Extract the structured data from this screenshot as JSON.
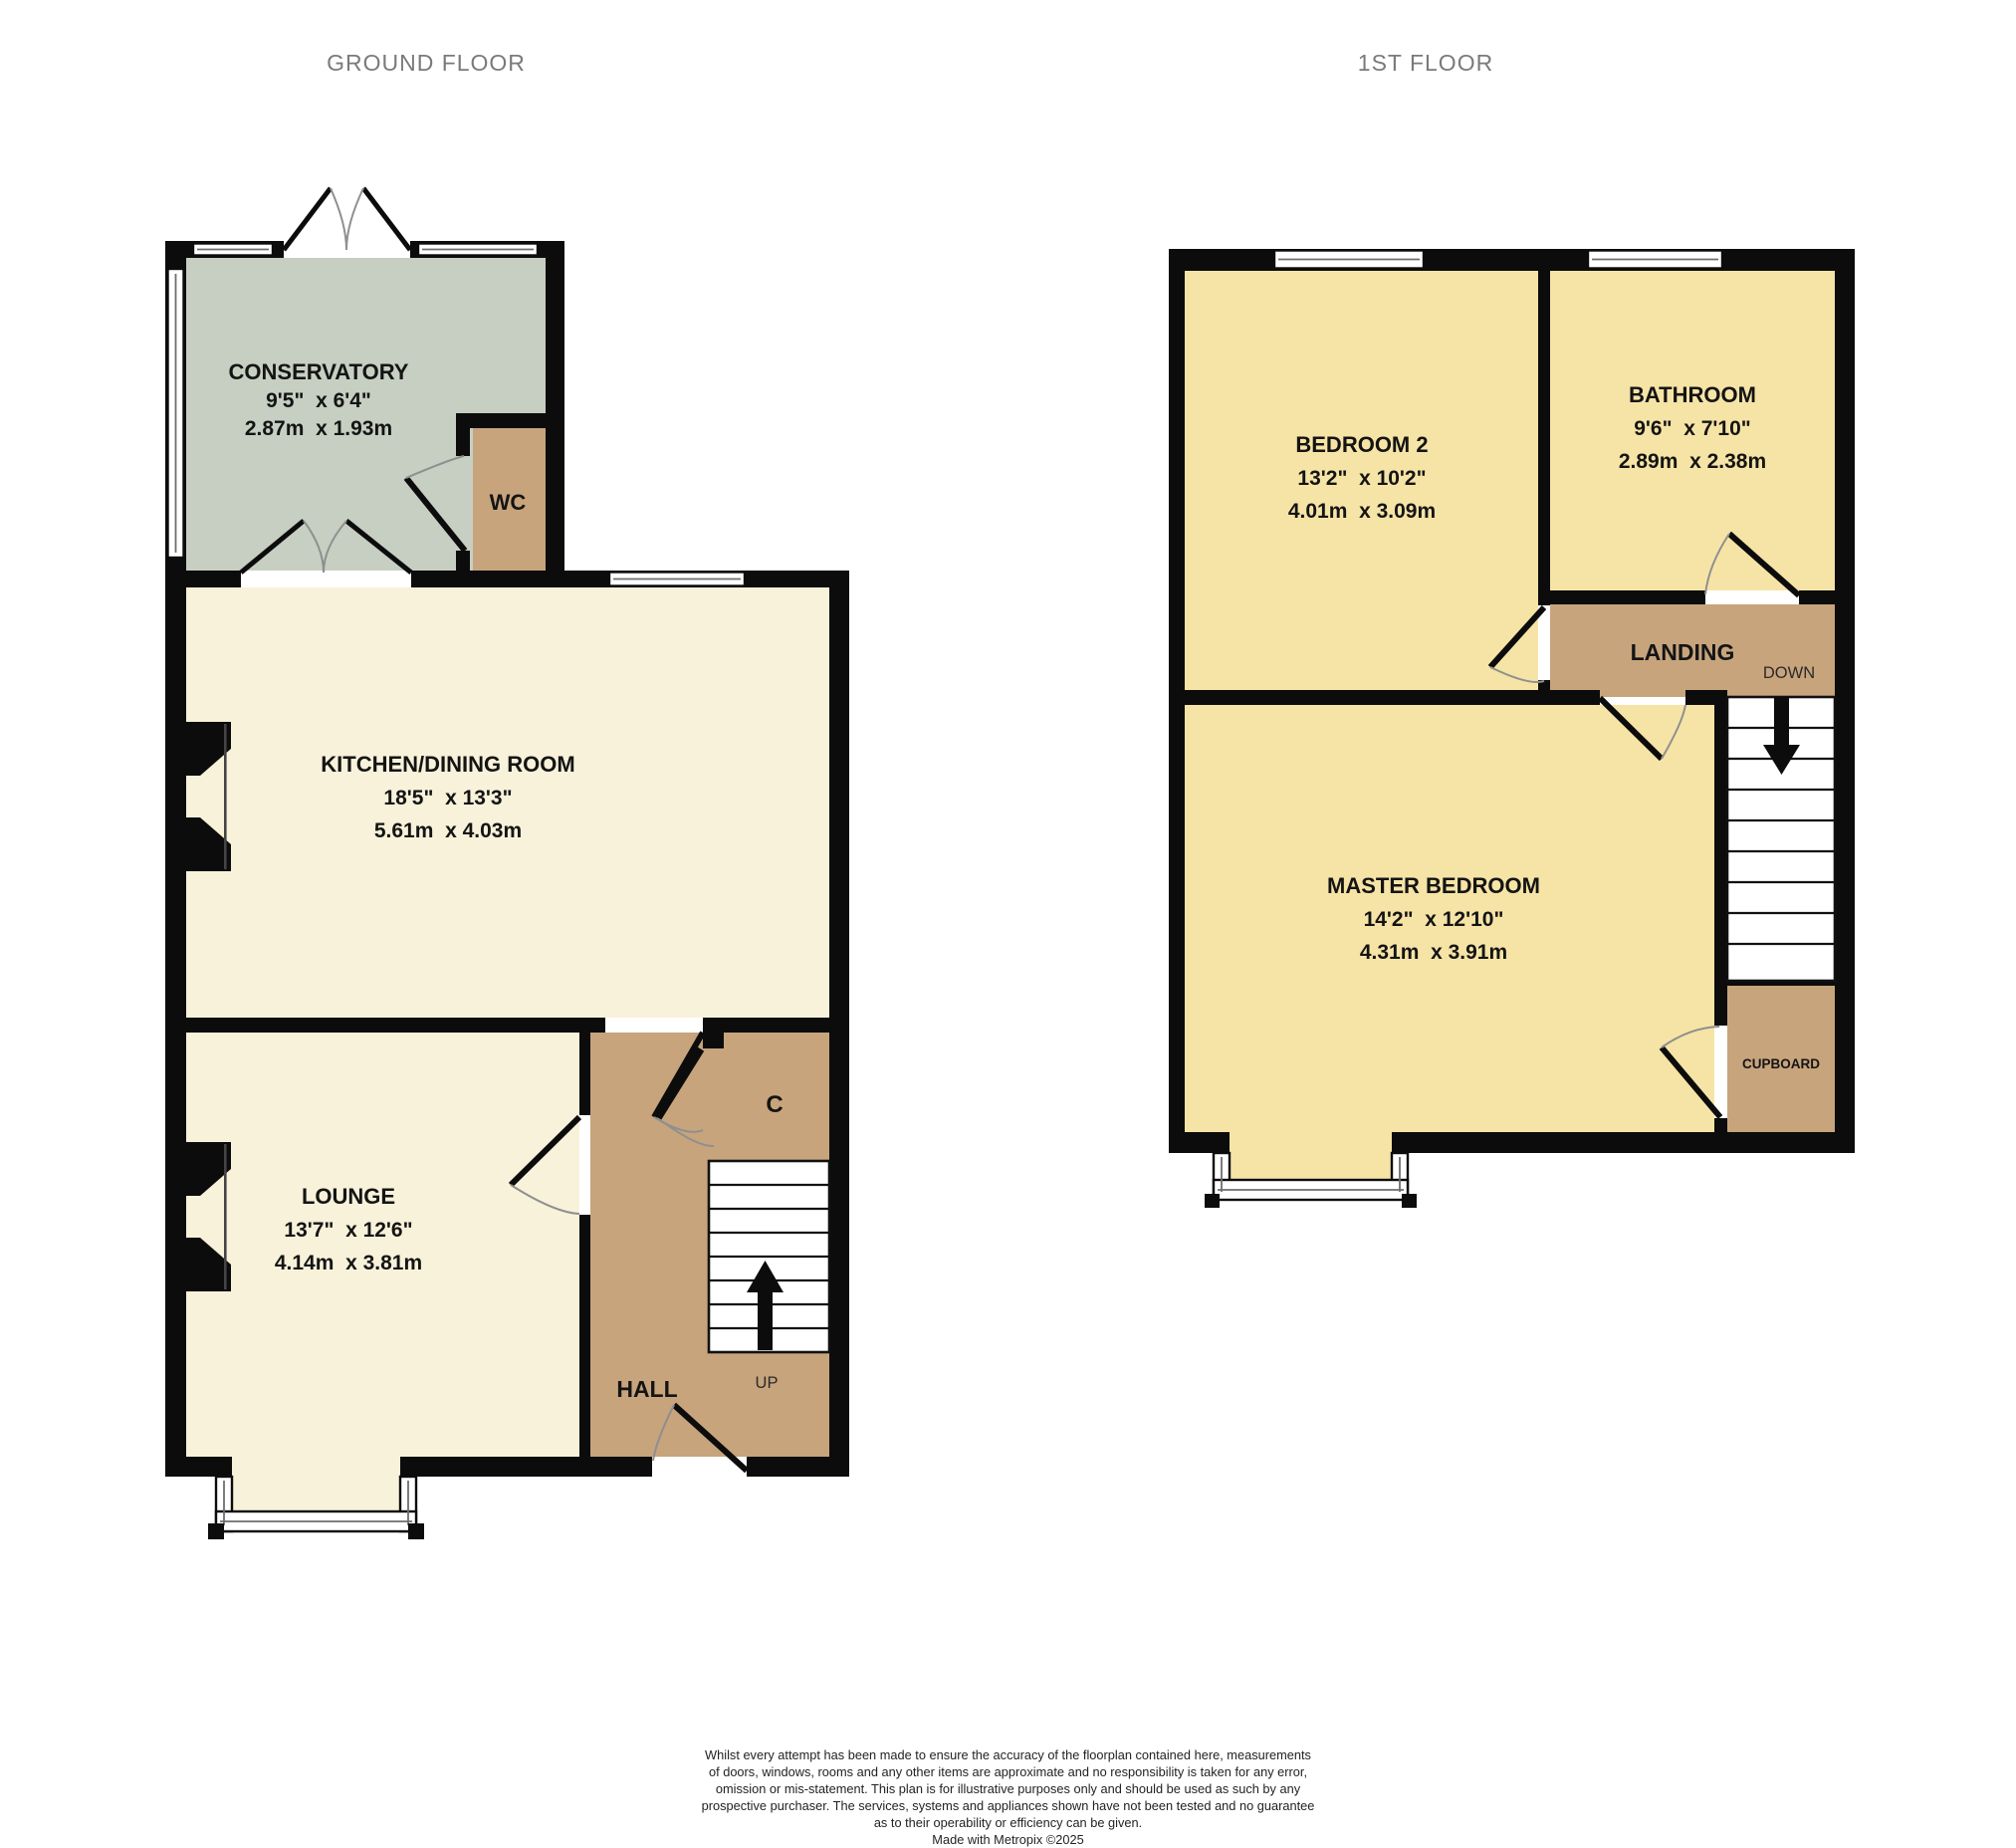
{
  "titles": {
    "ground_floor": "GROUND FLOOR",
    "first_floor": "1ST FLOOR"
  },
  "colors": {
    "wall": "#0c0c0c",
    "room_cream": "#f8f2da",
    "room_yellow": "#f6e4a6",
    "circulation_tan": "#c7a47c",
    "conservatory_green": "#c6cfc2",
    "stair_white": "#ffffff",
    "title_gray": "#7a7a7a",
    "label_black": "#141414"
  },
  "ground_floor": {
    "rooms": {
      "conservatory": {
        "name": "CONSERVATORY",
        "imperial": "9'5\"  x 6'4\"",
        "metric": "2.87m  x 1.93m"
      },
      "wc": {
        "name": "WC"
      },
      "kitchen": {
        "name": "KITCHEN/DINING ROOM",
        "imperial": "18'5\"  x 13'3\"",
        "metric": "5.61m  x 4.03m"
      },
      "lounge": {
        "name": "LOUNGE",
        "imperial": "13'7\"  x 12'6\"",
        "metric": "4.14m  x 3.81m"
      },
      "hall": {
        "name": "HALL"
      },
      "understairs_cupboard": {
        "name": "C"
      },
      "stairs": {
        "direction": "UP"
      }
    }
  },
  "first_floor": {
    "rooms": {
      "bedroom2": {
        "name": "BEDROOM 2",
        "imperial": "13'2\"  x 10'2\"",
        "metric": "4.01m  x 3.09m"
      },
      "bathroom": {
        "name": "BATHROOM",
        "imperial": "9'6\"  x 7'10\"",
        "metric": "2.89m  x 2.38m"
      },
      "landing": {
        "name": "LANDING"
      },
      "stairs": {
        "direction": "DOWN"
      },
      "master_bedroom": {
        "name": "MASTER BEDROOM",
        "imperial": "14'2\"  x 12'10\"",
        "metric": "4.31m  x 3.91m"
      },
      "cupboard": {
        "name": "CUPBOARD"
      }
    }
  },
  "footer": {
    "disclaimer_lines": [
      "Whilst every attempt has been made to ensure the accuracy of the floorplan contained here, measurements",
      "of doors, windows, rooms and any other items are approximate and no responsibility is taken for any error,",
      "omission or mis-statement. This plan is for illustrative purposes only and should be used as such by any",
      "prospective purchaser. The services, systems and appliances shown have not been tested and no guarantee",
      "as to their operability or efficiency can be given."
    ],
    "credit": "Made with Metropix ©2025"
  }
}
